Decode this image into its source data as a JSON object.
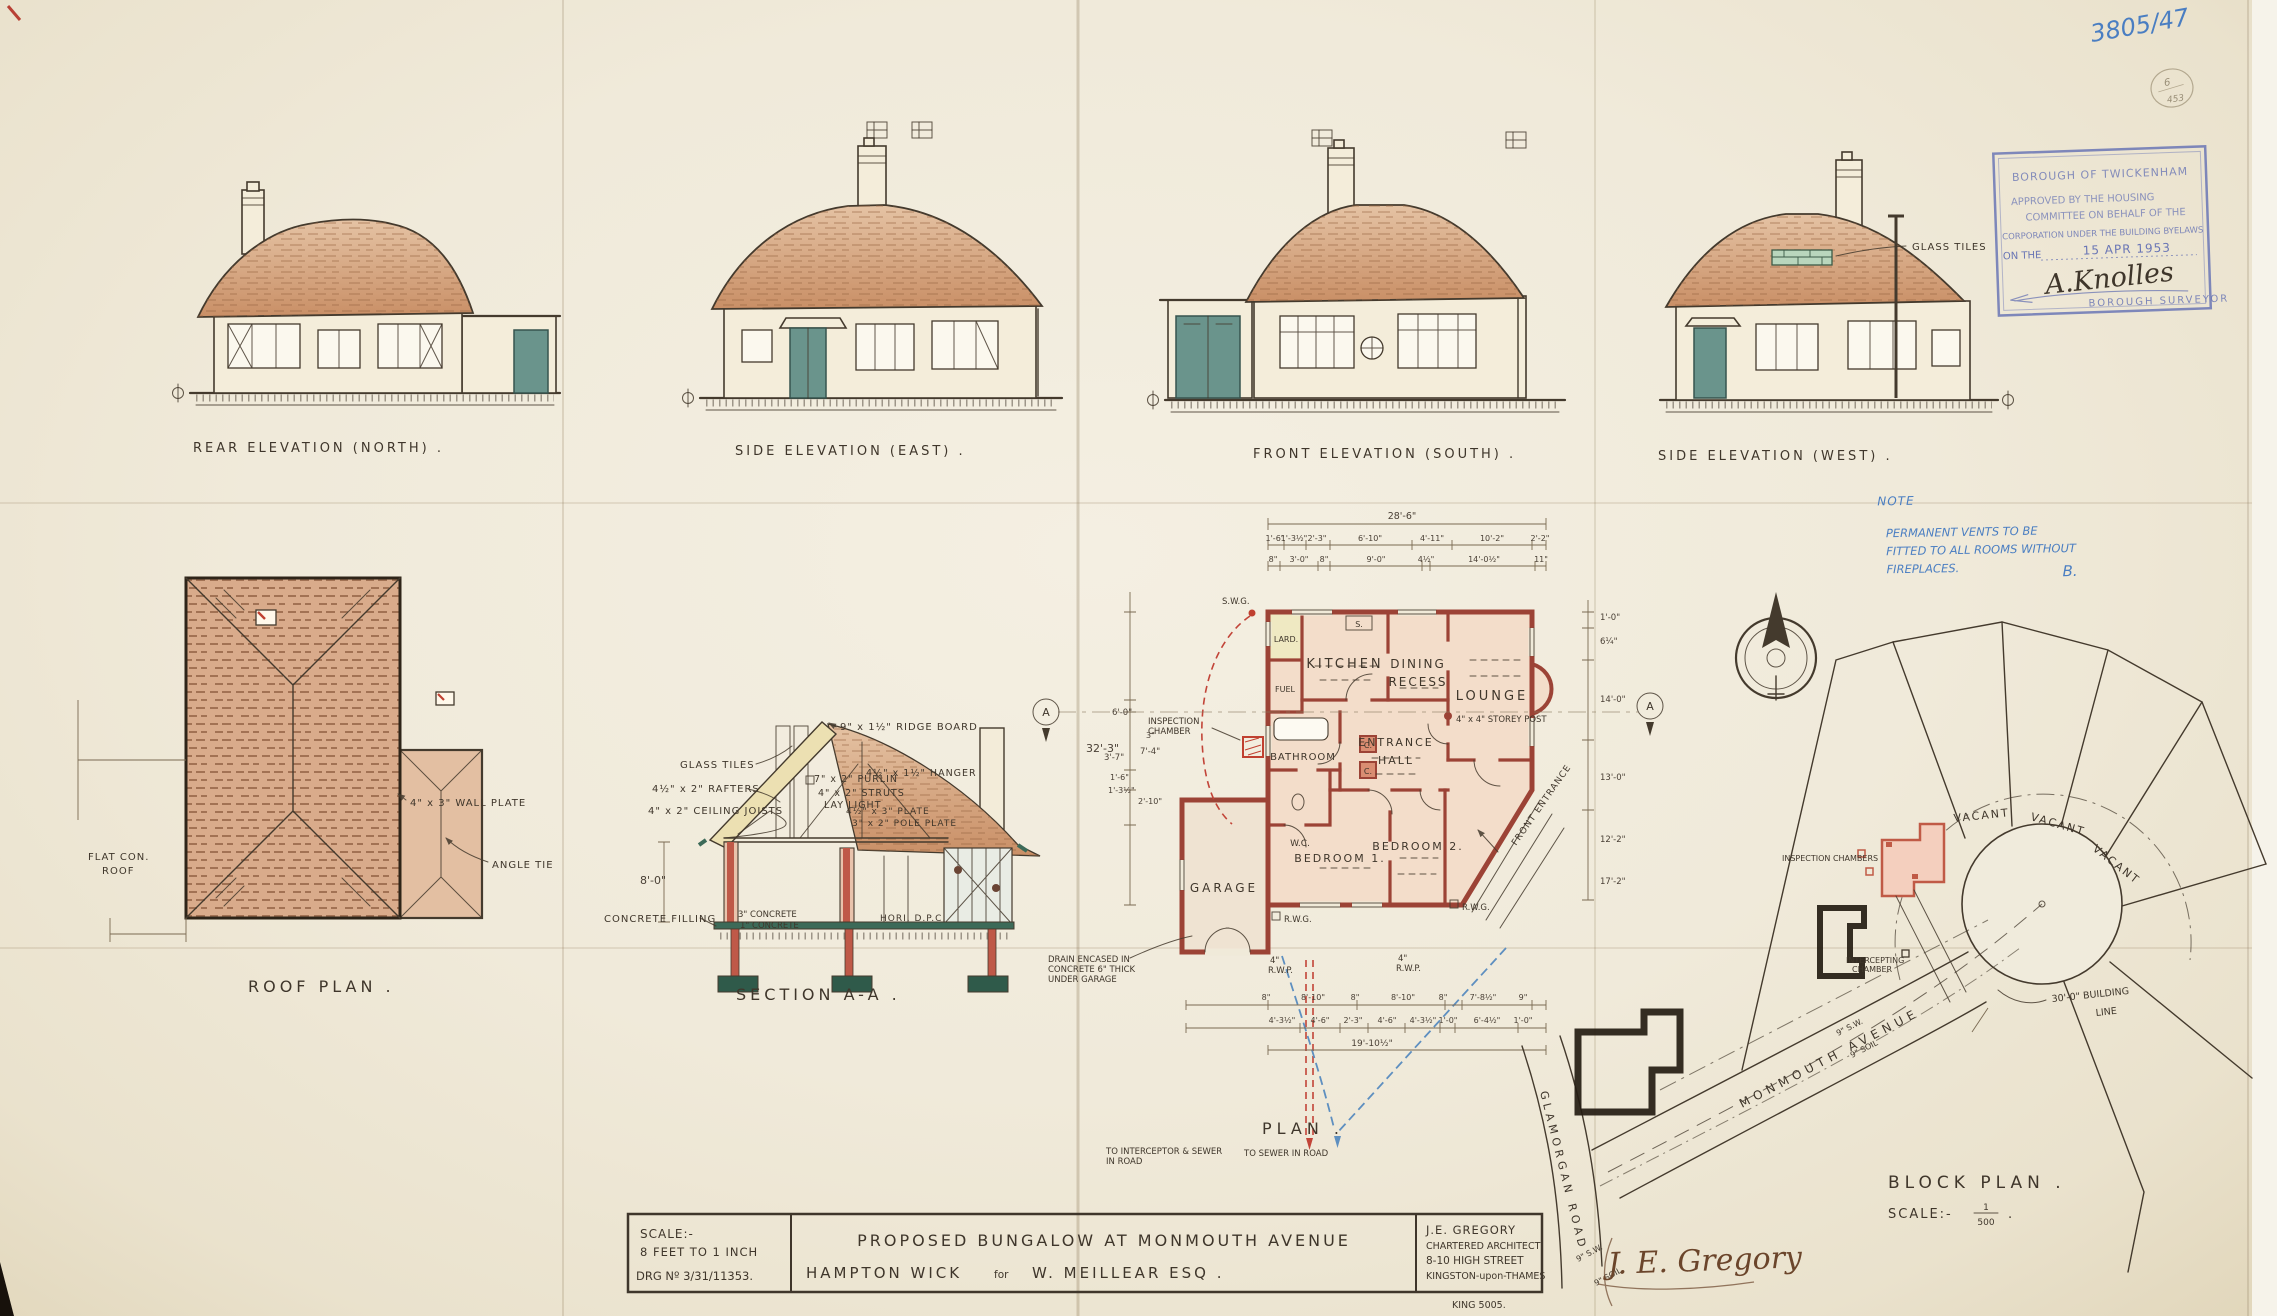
{
  "page": {
    "number_hand": "3805/47",
    "pencil_top": "6",
    "pencil_bottom": "453"
  },
  "stamp": {
    "l1": "BOROUGH OF TWICKENHAM",
    "l2": "APPROVED BY THE HOUSING",
    "l3": "COMMITTEE ON BEHALF OF THE",
    "l4": "CORPORATION UNDER THE BUILDING BYELAWS",
    "l5": "ON THE",
    "date": "15 APR 1953",
    "sig": "A.Knolles",
    "l6": "BOROUGH SURVEYOR"
  },
  "elevations": {
    "rear_label": "REAR ELEVATION (NORTH) .",
    "east_label": "SIDE ELEVATION (EAST) .",
    "front_label": "FRONT ELEVATION (SOUTH) .",
    "west_label": "SIDE ELEVATION (WEST) .",
    "glass_tiles": "GLASS TILES"
  },
  "roof_plan": {
    "title": "ROOF PLAN .",
    "wall_plate": "4\" x 3\" WALL PLATE",
    "angle_tie": "ANGLE TIE",
    "flat1": "FLAT CON.",
    "flat2": "ROOF"
  },
  "section": {
    "title": "SECTION A-A .",
    "ridge": "9\" x 1½\" RIDGE BOARD",
    "glass_tiles": "GLASS TILES",
    "rafters": "4½\" x 2\" RAFTERS",
    "purlin": "7\" x 2\" PURLIN",
    "struts": "4\" x 2\" STRUTS",
    "lay_light": "LAY LIGHT",
    "joists": "4\" x 2\" CEILING JOISTS",
    "hanger": "4½\" x 1½\" HANGER",
    "plate": "4½\" x 3\" PLATE",
    "pole_plate": "3\" x 2\" POLE PLATE",
    "wall_height": "8'-0\"",
    "concrete_filling": "CONCRETE FILLING",
    "concrete_a": "3\" CONCRETE",
    "concrete_b": "1\" CONCRETE",
    "dpc": "HORI. D.P.C."
  },
  "plan": {
    "title": "PLAN .",
    "rooms": {
      "kitchen": "KITCHEN",
      "dining_1": "DINING",
      "dining_2": "RECESS",
      "lounge": "LOUNGE",
      "larder": "LARD.",
      "fuel": "FUEL",
      "bathroom": "BATHROOM",
      "hall_1": "ENTRANCE",
      "hall_2": "HALL",
      "wc": "W.C.",
      "bed1": "BEDROOM 1.",
      "bed2": "BEDROOM 2.",
      "garage": "GARAGE",
      "cupboard": "C.",
      "sink": "S."
    },
    "labels": {
      "storey_post": "4\" x 4\" STOREY POST",
      "front_entrance": "FRONT ENTRANCE",
      "inspection_1": "INSPECTION",
      "inspection_2": "CHAMBER",
      "swg": "S.W.G.",
      "rwg": "R.W.G.",
      "rwp_1": "4\"",
      "rwp_2": "R.W.P.",
      "drain_1": "DRAIN ENCASED IN",
      "drain_2": "CONCRETE 6\" THICK",
      "drain_3": "UNDER GARAGE",
      "to_interceptor_1": "TO INTERCEPTOR & SEWER",
      "to_interceptor_2": "IN ROAD",
      "to_sewer": "TO SEWER IN ROAD",
      "section_marker": "A"
    },
    "dims": {
      "top_overall": "28'-6\"",
      "top_row1": [
        "1'-6\"",
        "1'-3½\"",
        "2'-3\"",
        "6'-10\"",
        "4'-11\"",
        "10'-2\"",
        "2'-2\""
      ],
      "top_row2": [
        "8\"",
        "3'-0\"",
        "8\"",
        "9'-0\"",
        "4½\"",
        "14'-0½\"",
        "11\""
      ],
      "left_overall": "32'-3\"",
      "left_chain": [
        "6'-0\"",
        "3\"",
        "7'-4\"",
        "3'-7\"",
        "1'-6\"",
        "1'-3½\"",
        "2'-10\""
      ],
      "bottom_row1": [
        "8\"",
        "8'-10\"",
        "8\"",
        "8'-10\"",
        "8\"",
        "7'-8½\"",
        "9\""
      ],
      "bottom_row2": [
        "4'-3½\"",
        "4'-6\"",
        "2'-3\"",
        "4'-6\"",
        "4'-3½\"",
        "1'-0\"",
        "6'-4½\"",
        "1'-0\""
      ],
      "bottom_overall": "19'-10½\"",
      "right_chain": [
        "1'-0\"",
        "6¼\"",
        "14'-0\"",
        "13'-0\"",
        "12'-2\"",
        "17'-2\""
      ]
    }
  },
  "block_plan": {
    "title": "BLOCK PLAN .",
    "scale_label": "SCALE:-",
    "scale_num": "1",
    "scale_den": "500",
    "scale_dot": ".",
    "vacant": "VACANT",
    "monmouth": "MONMOUTH AVENUE",
    "glamorgan": "GLAMORGAN ROAD",
    "building_line_1": "30'-0\" BUILDING",
    "building_line_2": "LINE",
    "inspection_chambers": "INSPECTION CHAMBERS",
    "intercepting_1": "INTERCEPTING",
    "intercepting_2": "CHAMBER",
    "pipe_sw": "9\" S.W.",
    "pipe_soil": "9\" SOIL"
  },
  "note": {
    "head": "NOTE",
    "line1": "PERMANENT VENTS TO BE",
    "line2": "FITTED TO ALL ROOMS WITHOUT",
    "line3": "FIREPLACES.",
    "initial": "B."
  },
  "title_block": {
    "scale_label": "SCALE:-",
    "scale_value": "8 FEET TO 1 INCH",
    "drg_no": "DRG Nº 3/31/11353.",
    "line1": "PROPOSED BUNGALOW AT MONMOUTH AVENUE",
    "line2a": "HAMPTON WICK",
    "line2b": "for",
    "line2c": "W. MEILLEAR ESQ .",
    "arch_name": "J.E. GREGORY",
    "arch_role": "CHARTERED ARCHITECT",
    "arch_addr1": "8-10 HIGH STREET",
    "arch_addr2": "KINGSTON-upon-THAMES",
    "phone": "KING 5005.",
    "signature": "J. E. Gregory"
  },
  "colors": {
    "paper": "#f0ead9",
    "ink": "#443a2d",
    "roof_tan": "#cf9a72",
    "plan_wall_red": "#9c4336",
    "teal_door": "#6a948c",
    "stamp_blue": "#6a76b5",
    "hand_blue": "#4a7ec2",
    "signature_brown": "#6b452b"
  }
}
